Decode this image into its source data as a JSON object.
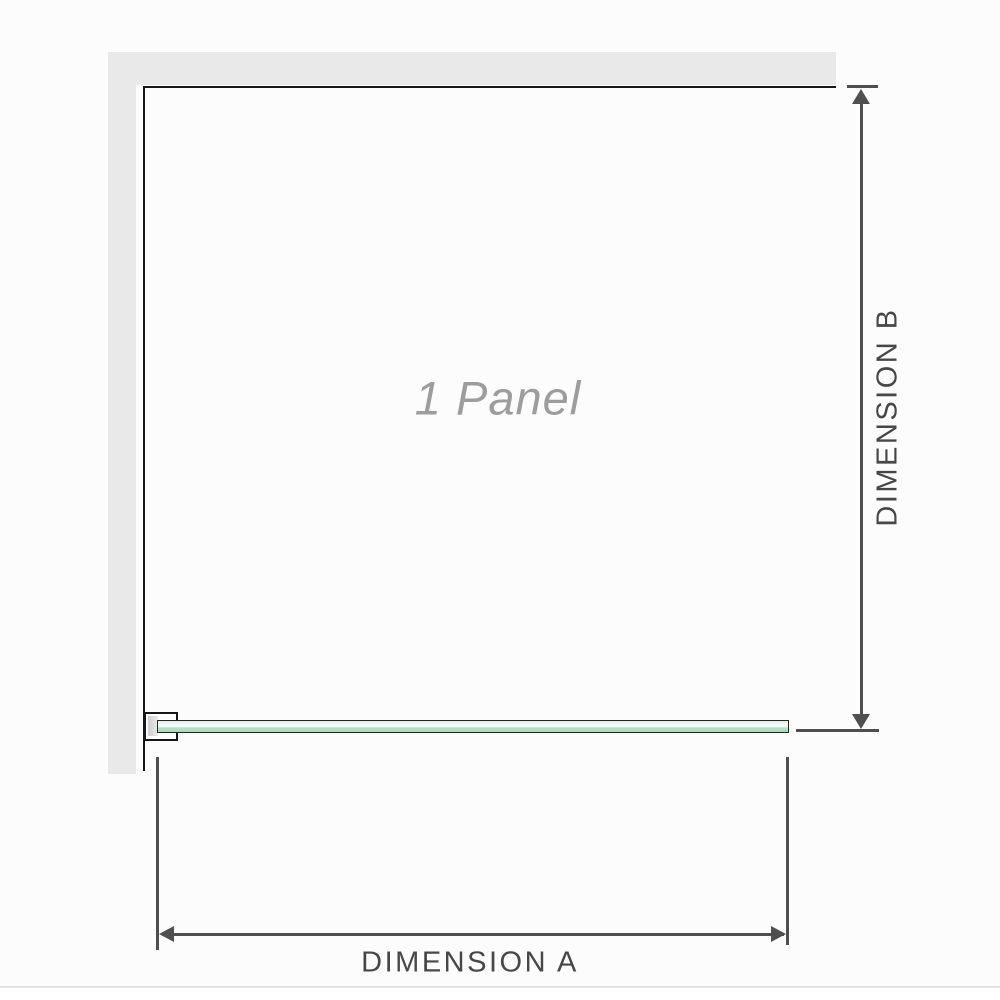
{
  "diagram": {
    "panel_label": "1 Panel",
    "dimension_a": {
      "label": "DIMENSION A"
    },
    "dimension_b": {
      "label": "DIMENSION B"
    },
    "colors": {
      "canvas_bg": "#fcfcfc",
      "wall": "#e9e9e9",
      "outline": "#161616",
      "dimension_line": "#4f4f4f",
      "dimension_text": "#474747",
      "panel_label_text": "#9d9d9d",
      "glass_fill": "#b9e0c9",
      "glass_fill_light": "#ddf1e6",
      "glass_border": "#1f2a24"
    }
  }
}
